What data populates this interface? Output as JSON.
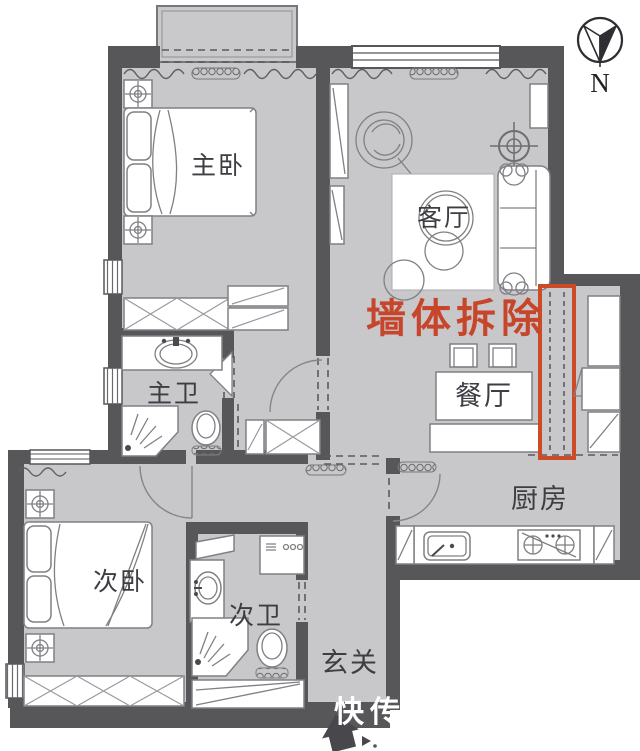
{
  "rooms": {
    "master_bedroom": "主卧",
    "living_room": "客厅",
    "master_bath": "主卫",
    "dining_room": "餐厅",
    "kitchen": "厨房",
    "second_bedroom": "次卧",
    "second_bath": "次卫",
    "entry": "玄关"
  },
  "annotation": {
    "wall_demolition": "墙体拆除"
  },
  "compass": {
    "north": "N"
  },
  "watermark": {
    "text": "快传号"
  },
  "colors": {
    "floor": "#c8c8cb",
    "wall": "#57575a",
    "demolition_red": "#c7452a",
    "furniture_line": "#808084"
  }
}
